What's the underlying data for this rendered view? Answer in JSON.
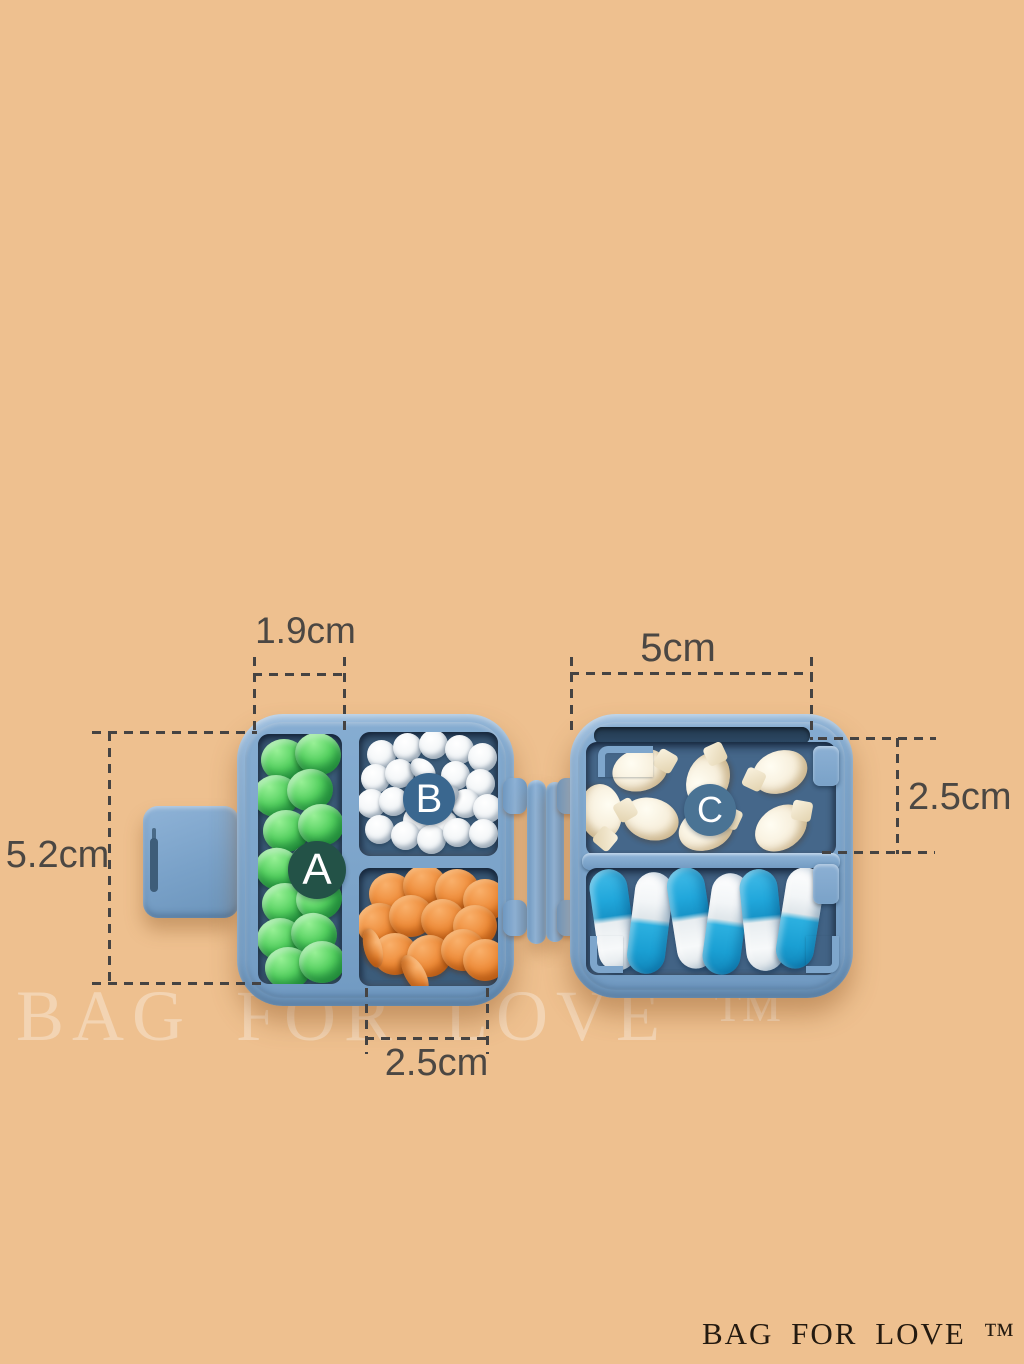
{
  "image_type": "product-photo of travel pill organizer with dimension callouts",
  "background_color": "#eec08f",
  "watermark": {
    "text": "BAG FOR LOVE ™"
  },
  "brand_logo": {
    "text": "BAG FOR LOVE ™",
    "color": "#241a10"
  },
  "annotations": {
    "line_color": "#454342",
    "text_color": "#4b4743",
    "top_left_width": {
      "text": "1.9cm"
    },
    "top_right_width": {
      "text": "5cm"
    },
    "left_height": {
      "text": "5.2cm"
    },
    "right_height": {
      "text": "2.5cm"
    },
    "bottom_width": {
      "text": "2.5cm"
    }
  },
  "product": {
    "shell_color": "#7ea6cc",
    "interior_color": "#3c5c7a",
    "badges": {
      "a": {
        "letter": "A",
        "color": "#235247"
      },
      "b": {
        "letter": "B",
        "color": "#3a678f"
      },
      "c": {
        "letter": "C",
        "color": "#4a7394"
      }
    },
    "pill_colors": {
      "green": "#47c354",
      "white": "#f1f4f6",
      "orange": "#e8802e",
      "fish_cream": "#f5eeda",
      "capsule_blue": "#21a7db"
    },
    "pills": {
      "green": [
        {
          "x": 26,
          "y": 26
        },
        {
          "x": 60,
          "y": 20,
          "r": 15
        },
        {
          "x": 18,
          "y": 62
        },
        {
          "x": 52,
          "y": 56,
          "r": -10
        },
        {
          "x": 28,
          "y": 97
        },
        {
          "x": 63,
          "y": 91
        },
        {
          "x": 20,
          "y": 135,
          "r": 20
        },
        {
          "x": 55,
          "y": 130
        },
        {
          "x": 27,
          "y": 170
        },
        {
          "x": 61,
          "y": 165,
          "r": -12
        },
        {
          "x": 22,
          "y": 205
        },
        {
          "x": 56,
          "y": 200,
          "r": 10
        },
        {
          "x": 30,
          "y": 234
        },
        {
          "x": 64,
          "y": 228
        }
      ],
      "white": [
        {
          "x": 22,
          "y": 22
        },
        {
          "x": 48,
          "y": 15
        },
        {
          "x": 74,
          "y": 12
        },
        {
          "x": 100,
          "y": 17
        },
        {
          "x": 123,
          "y": 25
        },
        {
          "x": 16,
          "y": 46
        },
        {
          "x": 40,
          "y": 41
        },
        {
          "x": 64,
          "y": 38,
          "w": 28,
          "h": 20,
          "r": 40
        },
        {
          "x": 96,
          "y": 43
        },
        {
          "x": 121,
          "y": 51
        },
        {
          "x": 12,
          "y": 71
        },
        {
          "x": 34,
          "y": 69
        },
        {
          "x": 58,
          "y": 88
        },
        {
          "x": 84,
          "y": 92
        },
        {
          "x": 106,
          "y": 71
        },
        {
          "x": 128,
          "y": 76
        },
        {
          "x": 20,
          "y": 97
        },
        {
          "x": 46,
          "y": 103
        },
        {
          "x": 72,
          "y": 107
        },
        {
          "x": 98,
          "y": 100
        },
        {
          "x": 124,
          "y": 101
        },
        {
          "x": 88,
          "y": 64,
          "w": 26,
          "h": 19,
          "r": -35
        }
      ],
      "orange": [
        {
          "x": 32,
          "y": 26
        },
        {
          "x": 66,
          "y": 18,
          "r": 10
        },
        {
          "x": 98,
          "y": 22
        },
        {
          "x": 126,
          "y": 32
        },
        {
          "x": 20,
          "y": 56,
          "r": -15
        },
        {
          "x": 52,
          "y": 48
        },
        {
          "x": 84,
          "y": 52,
          "r": 8
        },
        {
          "x": 116,
          "y": 58
        },
        {
          "x": 36,
          "y": 86
        },
        {
          "x": 70,
          "y": 88,
          "r": -10
        },
        {
          "x": 104,
          "y": 82
        },
        {
          "x": 126,
          "y": 92
        },
        {
          "x": 14,
          "y": 80,
          "w": 40,
          "h": 18,
          "r": 75
        },
        {
          "x": 56,
          "y": 106,
          "w": 42,
          "h": 20,
          "r": 60
        }
      ],
      "fish": [
        {
          "x": 54,
          "y": 28,
          "r": -15
        },
        {
          "x": 122,
          "y": 38,
          "r": -70
        },
        {
          "x": 194,
          "y": 30,
          "r": -20,
          "flip": true
        },
        {
          "x": 15,
          "y": 70,
          "r": 85
        },
        {
          "x": 65,
          "y": 77,
          "r": 15,
          "flip": true
        },
        {
          "x": 120,
          "y": 87,
          "r": -20
        },
        {
          "x": 195,
          "y": 86,
          "r": -35
        }
      ],
      "capsule": [
        {
          "x": 27,
          "y": 52,
          "r": -8
        },
        {
          "x": 64,
          "y": 55,
          "r": 7,
          "invert": true
        },
        {
          "x": 105,
          "y": 50,
          "r": -9
        },
        {
          "x": 140,
          "y": 56,
          "r": 8,
          "invert": true
        },
        {
          "x": 176,
          "y": 52,
          "r": -6
        },
        {
          "x": 214,
          "y": 50,
          "r": 9,
          "invert": true
        }
      ]
    }
  }
}
